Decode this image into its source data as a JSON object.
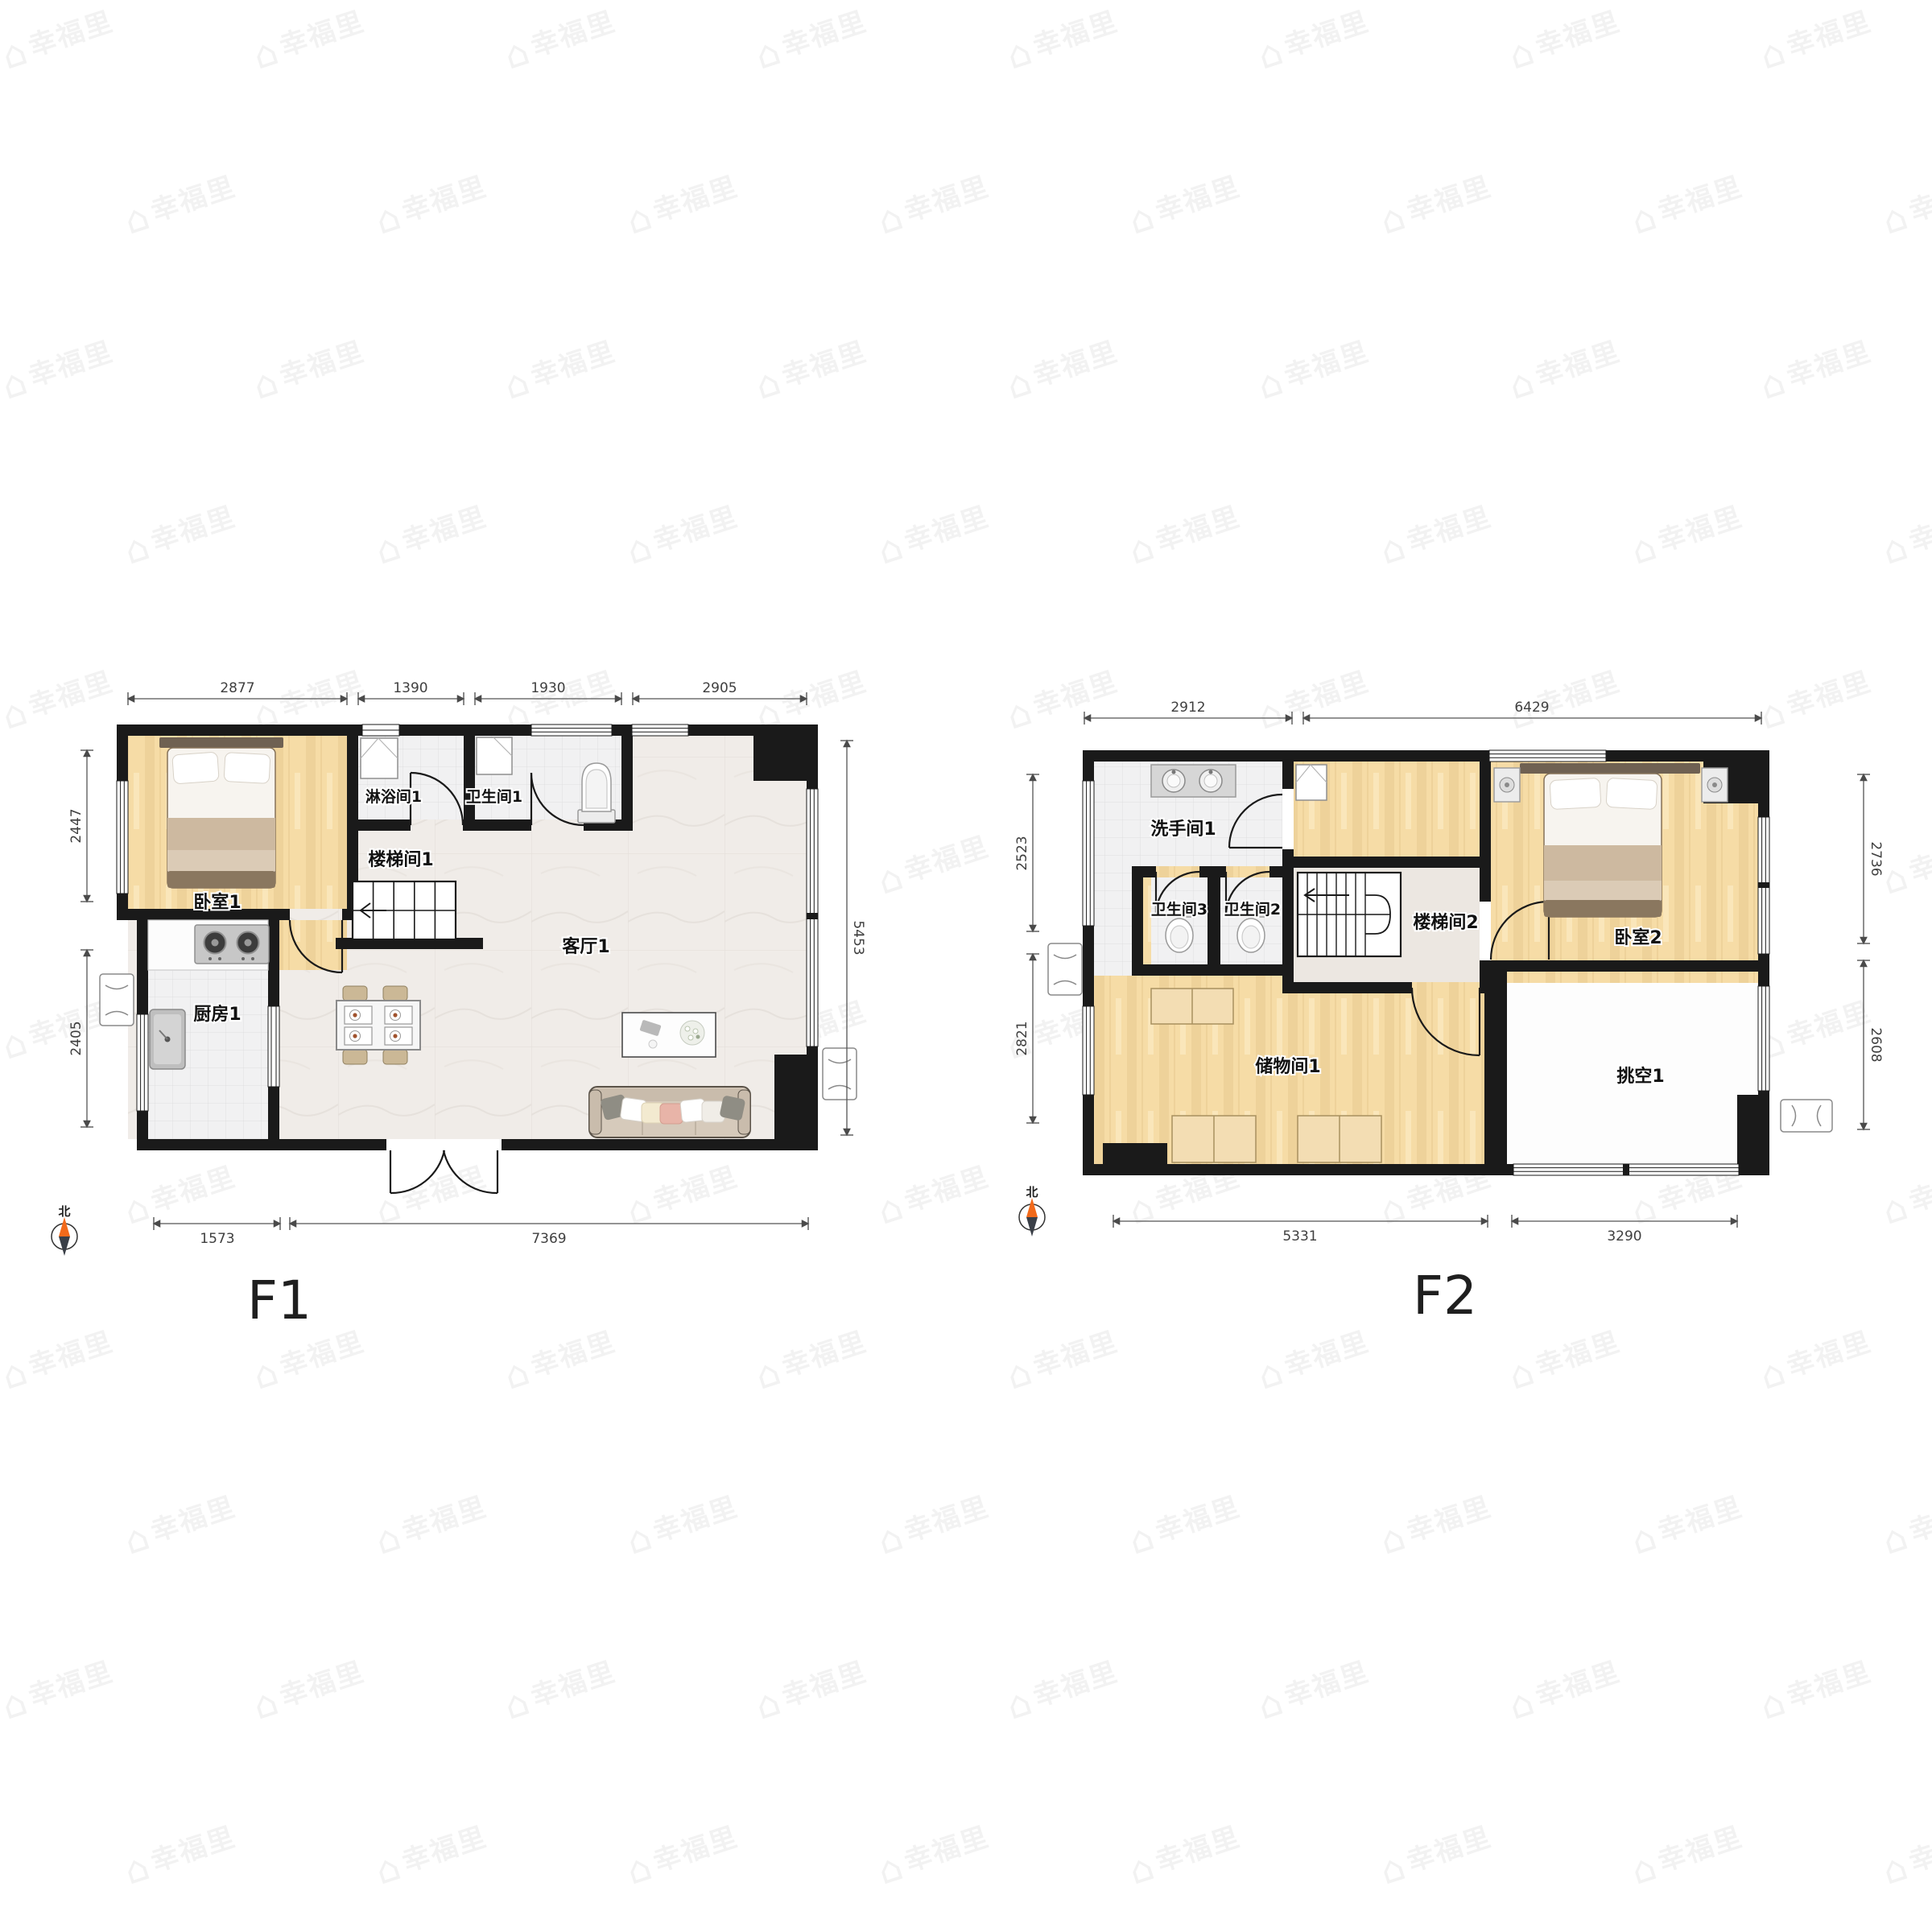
{
  "watermark": {
    "text": "幸福里"
  },
  "colors": {
    "wall": "#1a1a1a",
    "wood": "#f6dca6",
    "tile": "#f1f1f2",
    "marble": "#f0ece8",
    "north_needle": "#f26a1b"
  },
  "floors": [
    {
      "title": "F1",
      "compass": "北",
      "rooms": {
        "bedroom": "卧室1",
        "shower": "淋浴间1",
        "toilet": "卫生间1",
        "stair": "楼梯间1",
        "living": "客厅1",
        "kitchen": "厨房1"
      },
      "dims": {
        "top": [
          "2877",
          "1390",
          "1930",
          "2905"
        ],
        "left": [
          "2447",
          "2405"
        ],
        "right": [
          "5453"
        ],
        "bottom": [
          "1573",
          "7369"
        ]
      }
    },
    {
      "title": "F2",
      "compass": "北",
      "rooms": {
        "washroom": "洗手间1",
        "toilet3": "卫生间3",
        "toilet2": "卫生间2",
        "stair": "楼梯间2",
        "bedroom": "卧室2",
        "storage": "储物间1",
        "void": "挑空1"
      },
      "dims": {
        "top": [
          "2912",
          "6429"
        ],
        "left": [
          "2523",
          "2821"
        ],
        "right": [
          "2736",
          "2608"
        ],
        "bottom": [
          "5331",
          "3290"
        ]
      }
    }
  ]
}
